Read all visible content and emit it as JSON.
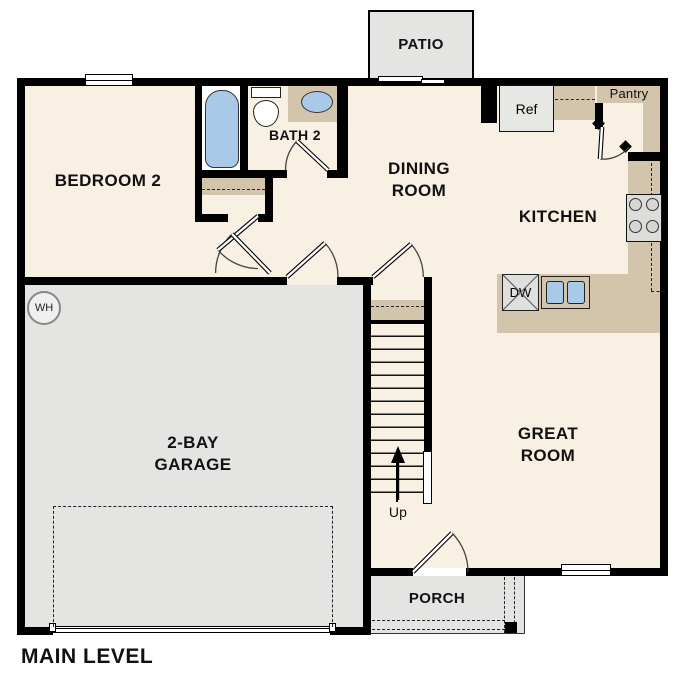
{
  "plan": {
    "level_label": "MAIN LEVEL",
    "rooms": {
      "bedroom2": "BEDROOM 2",
      "bath2": "BATH 2",
      "dining_line1": "DINING",
      "dining_line2": "ROOM",
      "kitchen": "KITCHEN",
      "great_line1": "GREAT",
      "great_line2": "ROOM",
      "garage_line1": "2-BAY",
      "garage_line2": "GARAGE",
      "patio": "PATIO",
      "porch": "PORCH",
      "pantry": "Pantry"
    },
    "fixtures": {
      "refrigerator": "Ref",
      "dishwasher": "DW",
      "water_heater": "WH"
    },
    "stairs": {
      "direction_label": "Up"
    },
    "colors": {
      "floor": "#f8f0e3",
      "garage": "#e4e4e2",
      "counter": "#d2c5ac",
      "fixture_blue": "#a9c9e9",
      "wall": "#000000",
      "background": "#ffffff"
    }
  }
}
